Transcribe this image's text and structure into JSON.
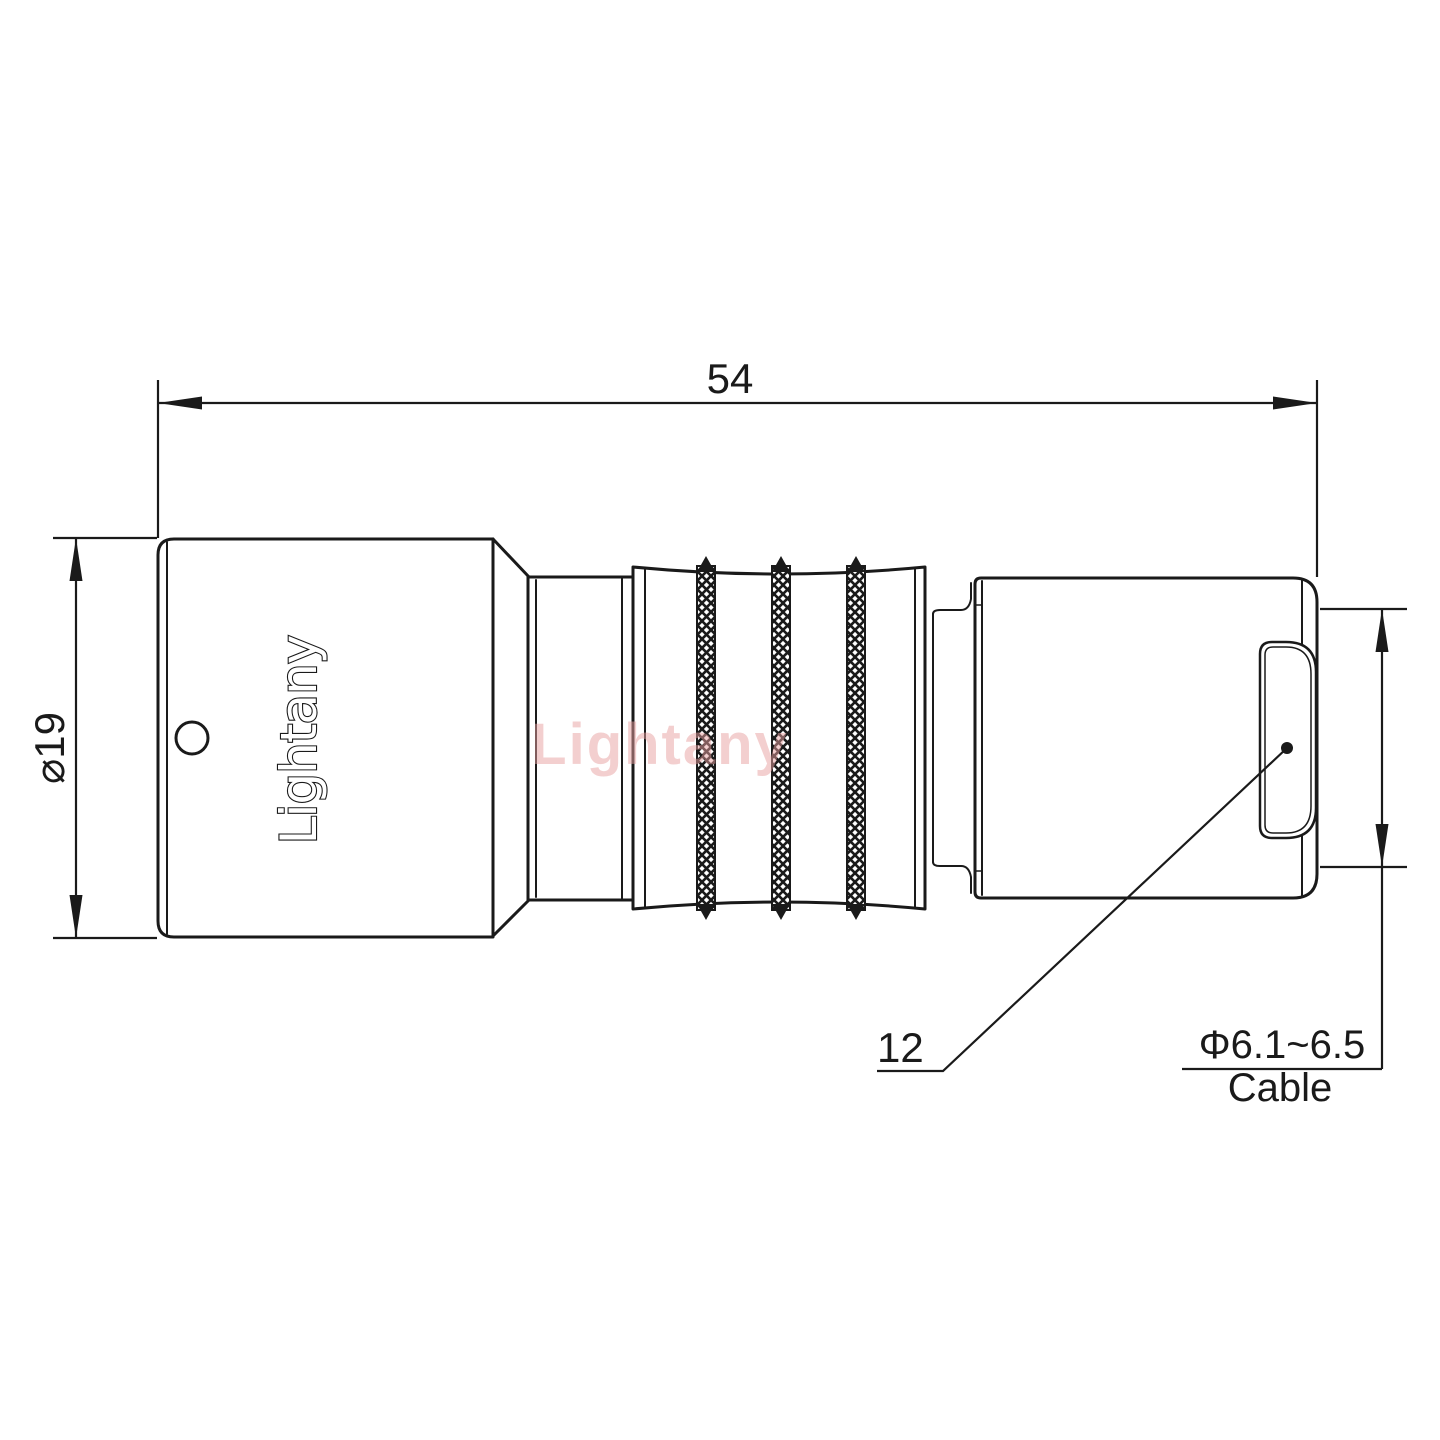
{
  "drawing": {
    "dim_overall_length": "54",
    "dim_body_diameter": "⌀19",
    "dim_bushing": "12",
    "cable_spec": "Φ6.1~6.5",
    "cable_label": "Cable"
  },
  "branding": {
    "body_logo": "Lightany",
    "watermark": "Lightany"
  },
  "colors": {
    "line": "#1a1a1a",
    "background": "#ffffff",
    "watermark": "#e8a0a0"
  }
}
